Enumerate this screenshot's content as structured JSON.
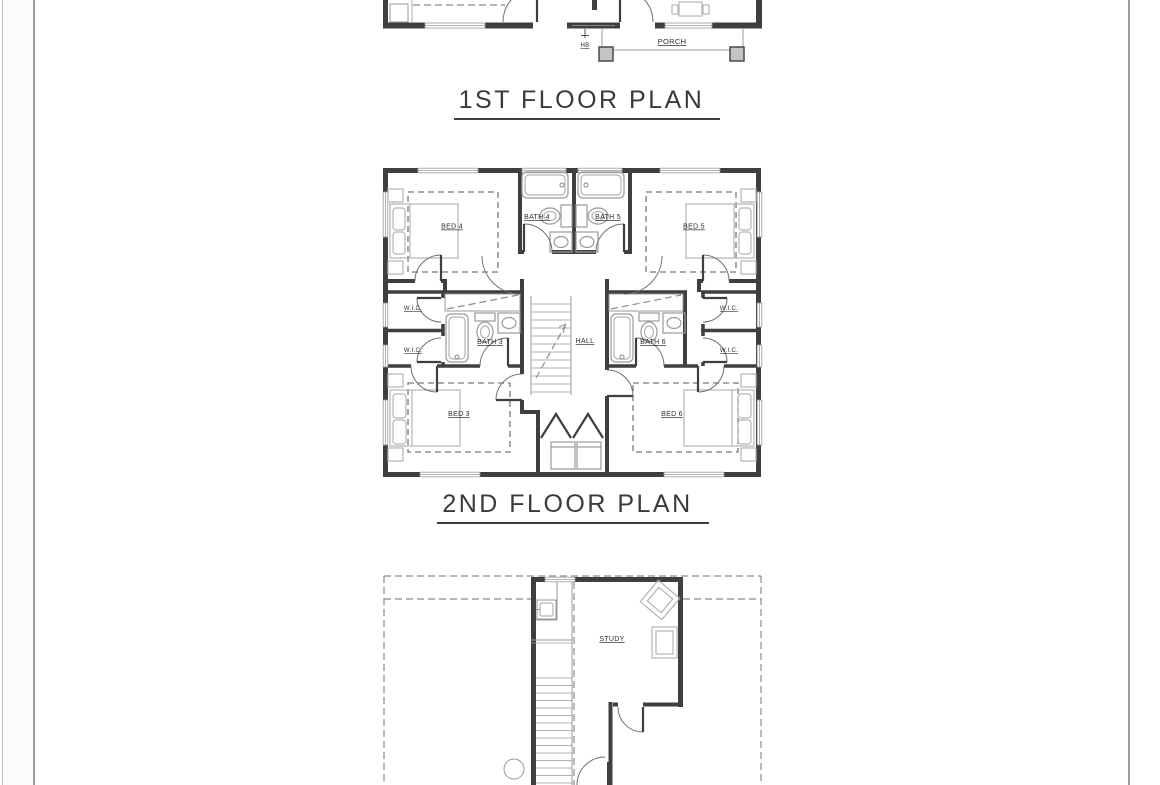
{
  "page": {
    "background": "#ffffff",
    "gutter_color": "#fcfcfc",
    "border_color": "#9e9e9e"
  },
  "plan_first": {
    "title": "1ST FLOOR PLAN",
    "labels": {
      "porch": "PORCH",
      "hose_bib": "HB"
    }
  },
  "plan_second": {
    "title": "2ND FLOOR PLAN",
    "labels": {
      "bed4": "BED 4",
      "bed5": "BED 5",
      "bed3": "BED 3",
      "bed6": "BED 6",
      "bath4": "BATH 4",
      "bath5": "BATH 5",
      "bath3": "BATH 3",
      "bath6": "BATH 6",
      "wic": "W.I.C.",
      "hall": "HALL"
    }
  },
  "plan_third": {
    "labels": {
      "study": "STUDY"
    }
  },
  "colors": {
    "wall": "#3f3f3f",
    "fixture_line": "#9a9a9a",
    "dashed_line": "#8c8c8c",
    "label_text": "#2b2b2b",
    "title_text": "#3a3a3a"
  }
}
